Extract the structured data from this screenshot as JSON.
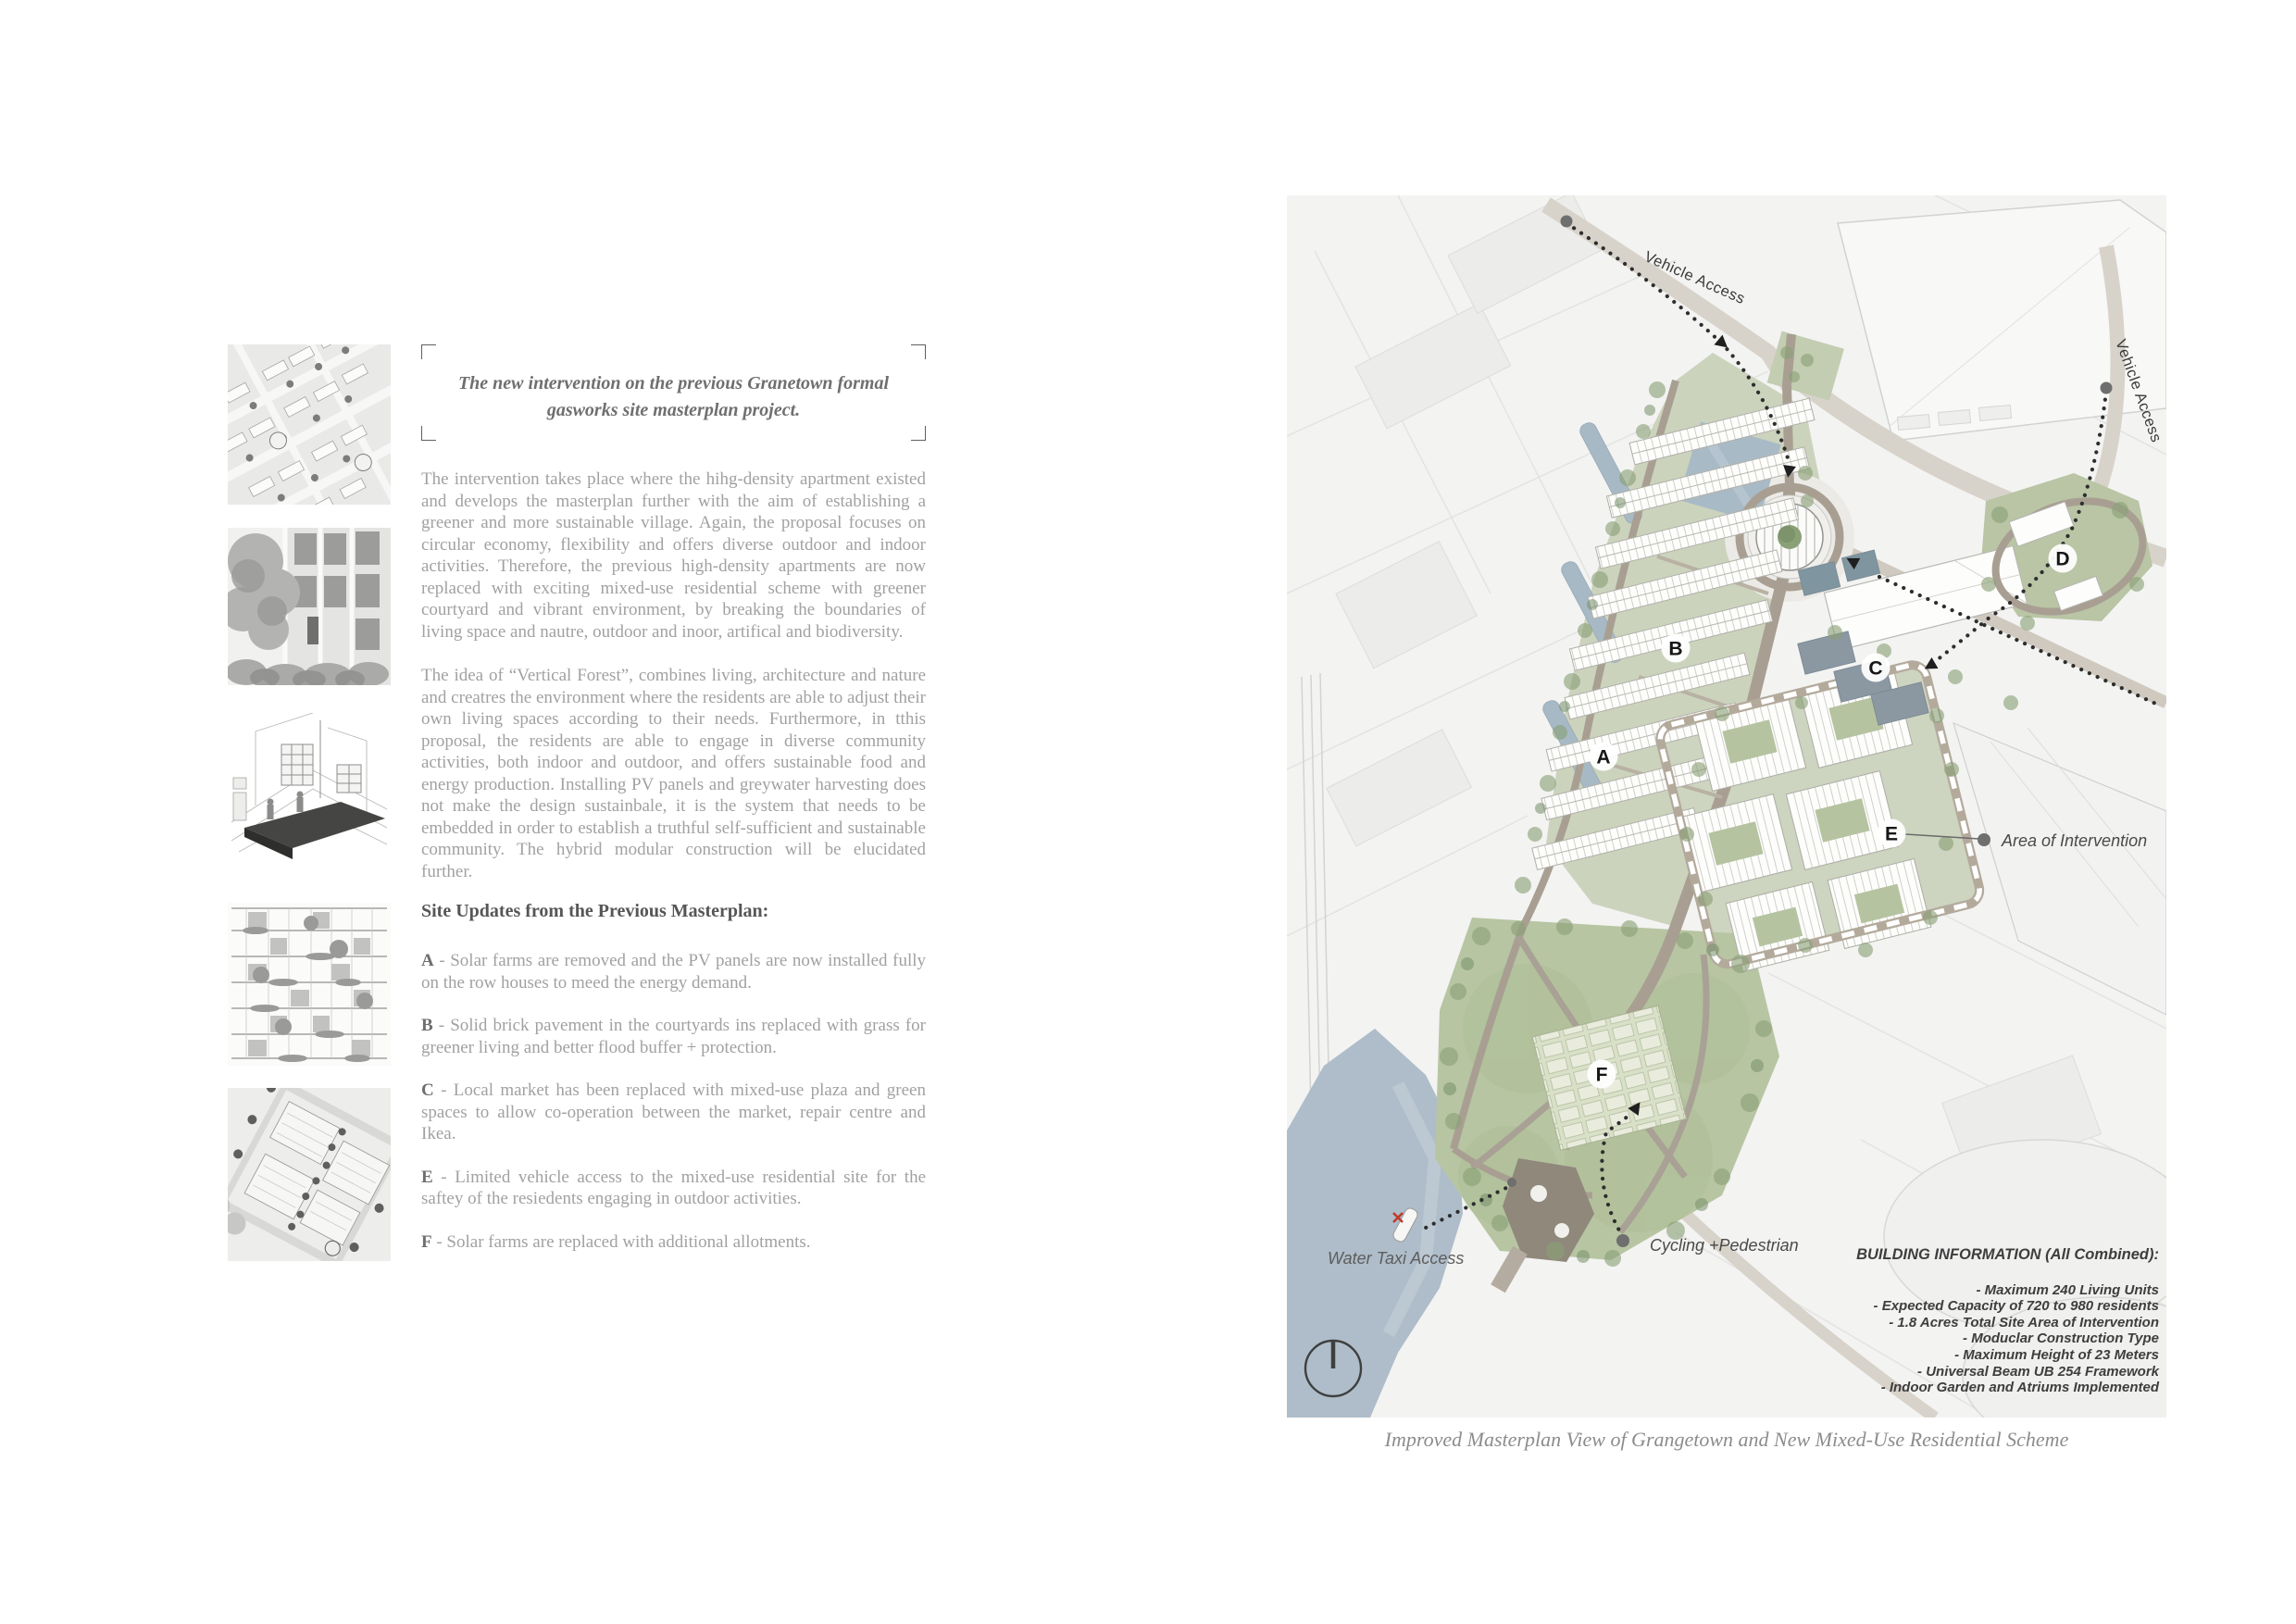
{
  "left_column": {
    "caption": "The new intervention on the previous Granetown formal gasworks site masterplan project.",
    "paragraphs": [
      "The intervention takes place where the hihg-density apartment existed and develops the masterplan further with the aim of establishing a greener and more sustainable village. Again, the proposal focuses on circular economy, flexibility and offers diverse outdoor and indoor activities. Therefore, the previous high-density apartments are now replaced with exciting mixed-use residential scheme with greener courtyard and vibrant environment, by breaking the boundaries of living space and nautre, outdoor and inoor, artifical and biodiversity.",
      "The idea of “Vertical Forest”, combines living, architecture and nature and creatres the environment where the residents are able to adjust their own living spaces according to their needs. Furthermore, in tthis proposal, the residents are able to engage in diverse community activities, both indoor and outdoor, and offers sustainable food and energy production. Installing PV panels and greywater harvesting does not make the design sustainbale, it is the system that needs to be embedded in order to establish a truthful self-sufficient and sustainable community. The hybrid modular construction will be elucidated further."
    ],
    "site_updates_heading": "Site Updates from the Previous Masterplan:",
    "site_updates": [
      {
        "key": "A",
        "text": "- Solar farms are removed and the PV panels are now installed fully on the row houses to meed the energy demand."
      },
      {
        "key": "B",
        "text": "- Solid brick pavement in the courtyards ins replaced with grass for greener living and better flood buffer + protection."
      },
      {
        "key": "C",
        "text": "- Local market has been replaced with mixed-use plaza and green spaces to allow co-operation between the market, repair centre and Ikea."
      },
      {
        "key": "E",
        "text": "- Limited vehicle access to the mixed-use residential site for the saftey of the resiedents engaging in outdoor activities."
      },
      {
        "key": "F",
        "text": "- Solar farms are replaced with additional allotments."
      }
    ],
    "thumbnails": [
      {
        "name": "masterplan-aerial-thumbnail"
      },
      {
        "name": "vertical-forest-photo-thumbnail"
      },
      {
        "name": "construction-axonometric-thumbnail"
      },
      {
        "name": "facade-elevation-thumbnail"
      },
      {
        "name": "courtyard-plan-thumbnail"
      }
    ]
  },
  "map": {
    "labels": {
      "vehicle_access_top": "Vehicle Access",
      "vehicle_access_right": "Vehicle Access",
      "area_of_intervention": "Area of Intervention",
      "water_taxi_access": "Water Taxi Access",
      "cycling_pedestrian": "Cycling +Pedestrian"
    },
    "markers": {
      "a": "A",
      "b": "B",
      "c": "C",
      "d": "D",
      "e": "E",
      "f": "F"
    },
    "building_info": {
      "title": "BUILDING INFORMATION (All Combined):",
      "lines": [
        "- Maximum 240 Living Units",
        "- Expected Capacity of 720 to 980 residents",
        "- 1.8 Acres Total Site Area of Intervention",
        "- Moduclar Construction Type",
        "- Maximum Height of 23 Meters",
        "- Universal Beam UB 254 Framework",
        "- Indoor Garden and Atriums Implemented"
      ]
    },
    "caption": "Improved Masterplan View of Grangetown and New Mixed-Use Residential Scheme"
  },
  "colors": {
    "text_muted": "#a1a1a1",
    "text_dark": "#565656",
    "map_green": "#b7c5a2",
    "map_road": "#a89f92",
    "map_water": "#a9b9c6",
    "marker_bg": "#ffffff",
    "dotted_path": "#2e2e2e"
  }
}
